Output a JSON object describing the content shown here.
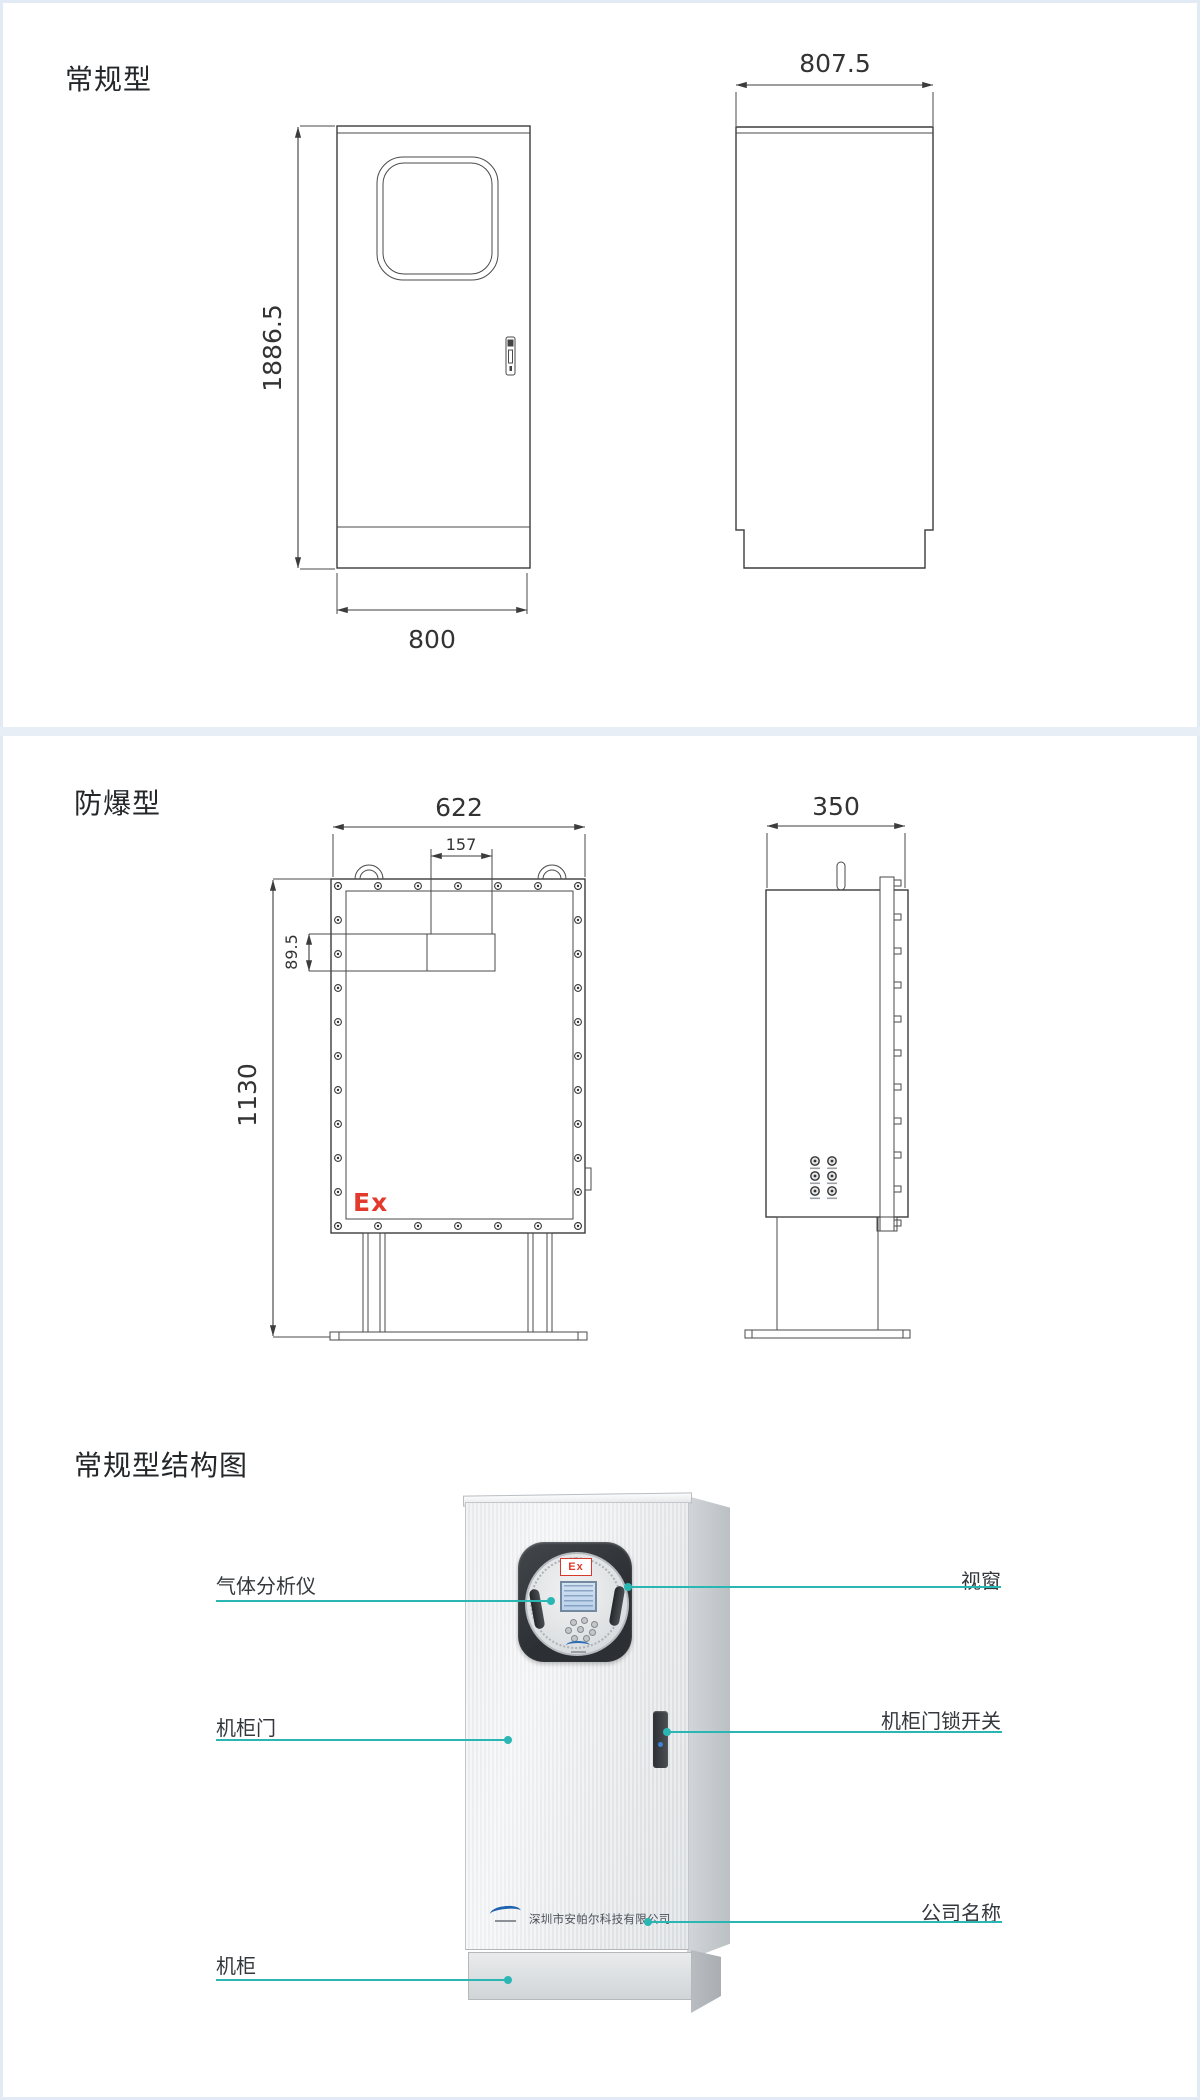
{
  "theme": {
    "teal": "#2ab7b4",
    "red": "#e23a2c",
    "line": "#3c3c3c",
    "divider": "#e8eef6",
    "page-border": "#e2ebf5",
    "label": "#34383d",
    "dim": "#333333"
  },
  "sections": {
    "regular": {
      "title": "常规型",
      "front": {
        "height_label": "1886.5",
        "width_label": "800"
      },
      "side": {
        "depth_label": "807.5"
      }
    },
    "explosion": {
      "title": "防爆型",
      "front": {
        "width_label": "622",
        "port_width_label": "157",
        "port_height_label": "89.5",
        "height_label": "1130",
        "ex_label": "Ex"
      },
      "side": {
        "depth_label": "350"
      }
    },
    "structure": {
      "title": "常规型结构图",
      "callouts": {
        "gas_analyzer": "气体分析仪",
        "window": "视窗",
        "cabinet_door": "机柜门",
        "lock_switch": "机柜门锁开关",
        "company_name": "公司名称",
        "cabinet": "机柜"
      },
      "cabinet": {
        "ex_label": "Ex",
        "company_text": "深圳市安帕尔科技有限公司"
      }
    }
  }
}
